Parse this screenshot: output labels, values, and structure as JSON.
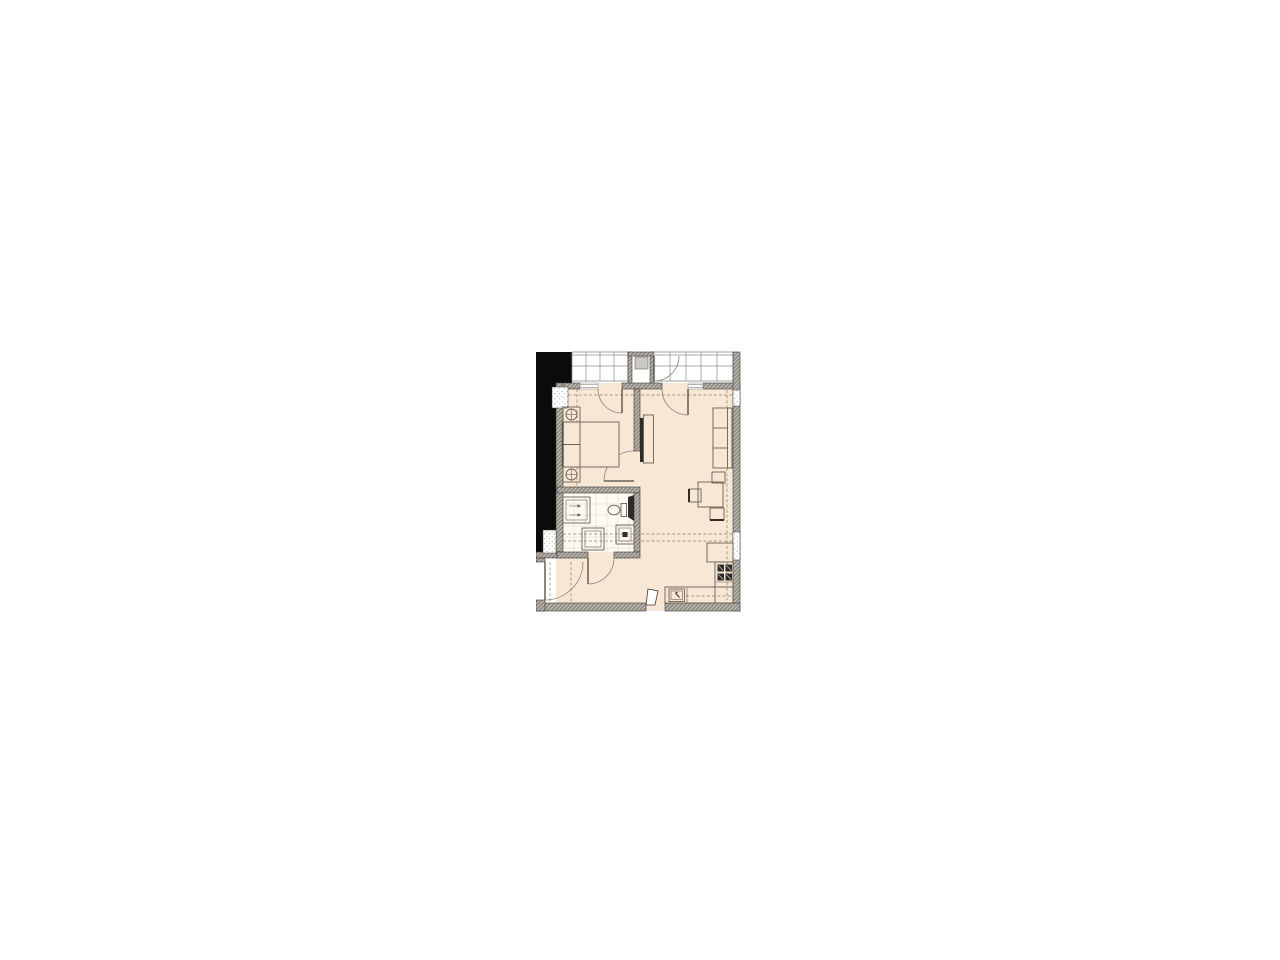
{
  "page": {
    "background_color": "#ffffff"
  },
  "floorplan": {
    "type": "apartment-floor-plan",
    "visible_text": [],
    "colors": {
      "floor": "#f7e7d4",
      "bathroom_floor": "#fdfaf3",
      "balcony_floor": "#ffffff",
      "wall_hatch_base": "#b6b2ab",
      "wall_hatch_line": "#6b6861",
      "wall_line": "#3d3a35",
      "solid_mass": "#0b0b0b",
      "furniture_line": "#6b6054",
      "dark_fixture": "#2e2c28",
      "dashed_line": "#8a7f6f",
      "glazing_line": "#8c8c8c",
      "shaft_fill": "#c9c9c9",
      "tile_line": "#ddd5c6"
    },
    "rooms": [
      {
        "name": "balcony",
        "position": "top",
        "features": [
          "glazing-grid",
          "divider-closet",
          "shaft",
          "balcony-partition-door"
        ]
      },
      {
        "name": "bedroom",
        "position": "top-left",
        "features": [
          "double-bed",
          "two-nightstand-lamps",
          "left-wall-window",
          "balcony-door"
        ]
      },
      {
        "name": "living-dining-room",
        "position": "right",
        "features": [
          "three-seat-sofa",
          "dining-table",
          "three-chairs",
          "tv",
          "tv-console",
          "balcony-door",
          "right-wall-windows"
        ]
      },
      {
        "name": "bathroom",
        "position": "middle-left",
        "features": [
          "vanity-sink",
          "toilet",
          "duct",
          "washing-machine",
          "storage-box",
          "tile-grid"
        ]
      },
      {
        "name": "hallway",
        "position": "bottom-left",
        "features": [
          "entry-door",
          "wardrobe-dashes"
        ]
      },
      {
        "name": "kitchen",
        "position": "bottom-right",
        "features": [
          "counter-l-shape",
          "stove-4-burner",
          "kitchen-sink",
          "base-cabinet",
          "service-opening"
        ]
      }
    ],
    "symbols": [
      "door-swing-arc",
      "dashed-overhang-line",
      "wall-hatch",
      "window-speckle-block",
      "solid-adjacent-mass"
    ]
  }
}
